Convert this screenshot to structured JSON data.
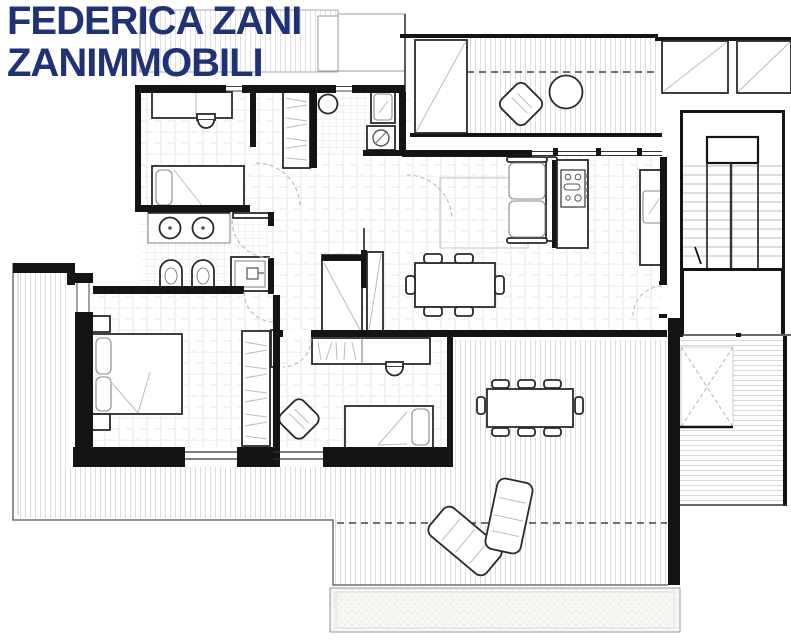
{
  "header": {
    "line1": "FEDERICA ZANI",
    "line2": "ZANIMMOBILI"
  },
  "colors": {
    "brand_text": "#1f3374",
    "wall": "#141414",
    "furniture_stroke": "#2a2a2a",
    "tile_line": "#e6e6e6",
    "deck_line": "#d9d9d9",
    "dash_line": "#bdbdbd",
    "paper": "#ffffff"
  },
  "plan": {
    "kind": "apartment floor plan drawing",
    "icon_names": [
      "washing-machine-icon",
      "shower-icon",
      "round-sink-icon",
      "toilet-icon",
      "bidet-icon",
      "cooktop-icon",
      "staircase-icon",
      "skylight-icon",
      "wardrobe-icon",
      "sun-lounger-icon"
    ]
  }
}
